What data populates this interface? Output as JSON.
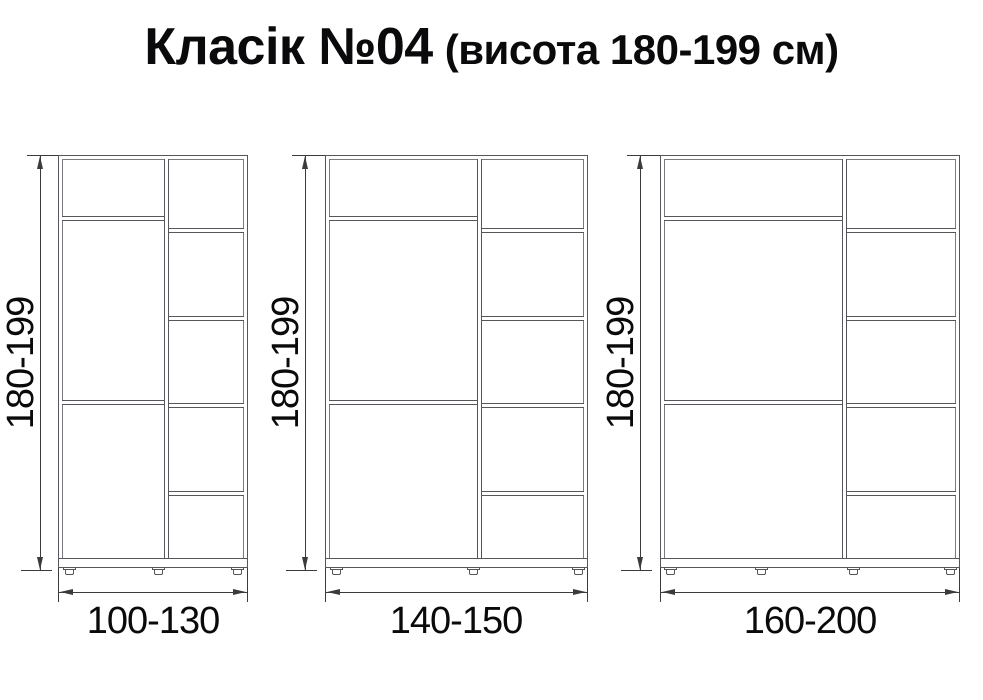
{
  "title": {
    "main": "Класік №04",
    "suffix": "(висота 180-199 см)"
  },
  "cabinets": [
    {
      "height_label": "180-199",
      "width_label": "100-130",
      "feet_count": 3,
      "left_section_shelves": 2,
      "right_section_shelves": 4
    },
    {
      "height_label": "180-199",
      "width_label": "140-150",
      "feet_count": 3,
      "left_section_shelves": 2,
      "right_section_shelves": 4
    },
    {
      "height_label": "180-199",
      "width_label": "160-200",
      "feet_count": 4,
      "left_section_shelves": 2,
      "right_section_shelves": 4
    }
  ],
  "colors": {
    "line": "#55565a",
    "dimension": "#3a3b3e",
    "text": "#0a0a0c",
    "background": "#ffffff"
  }
}
